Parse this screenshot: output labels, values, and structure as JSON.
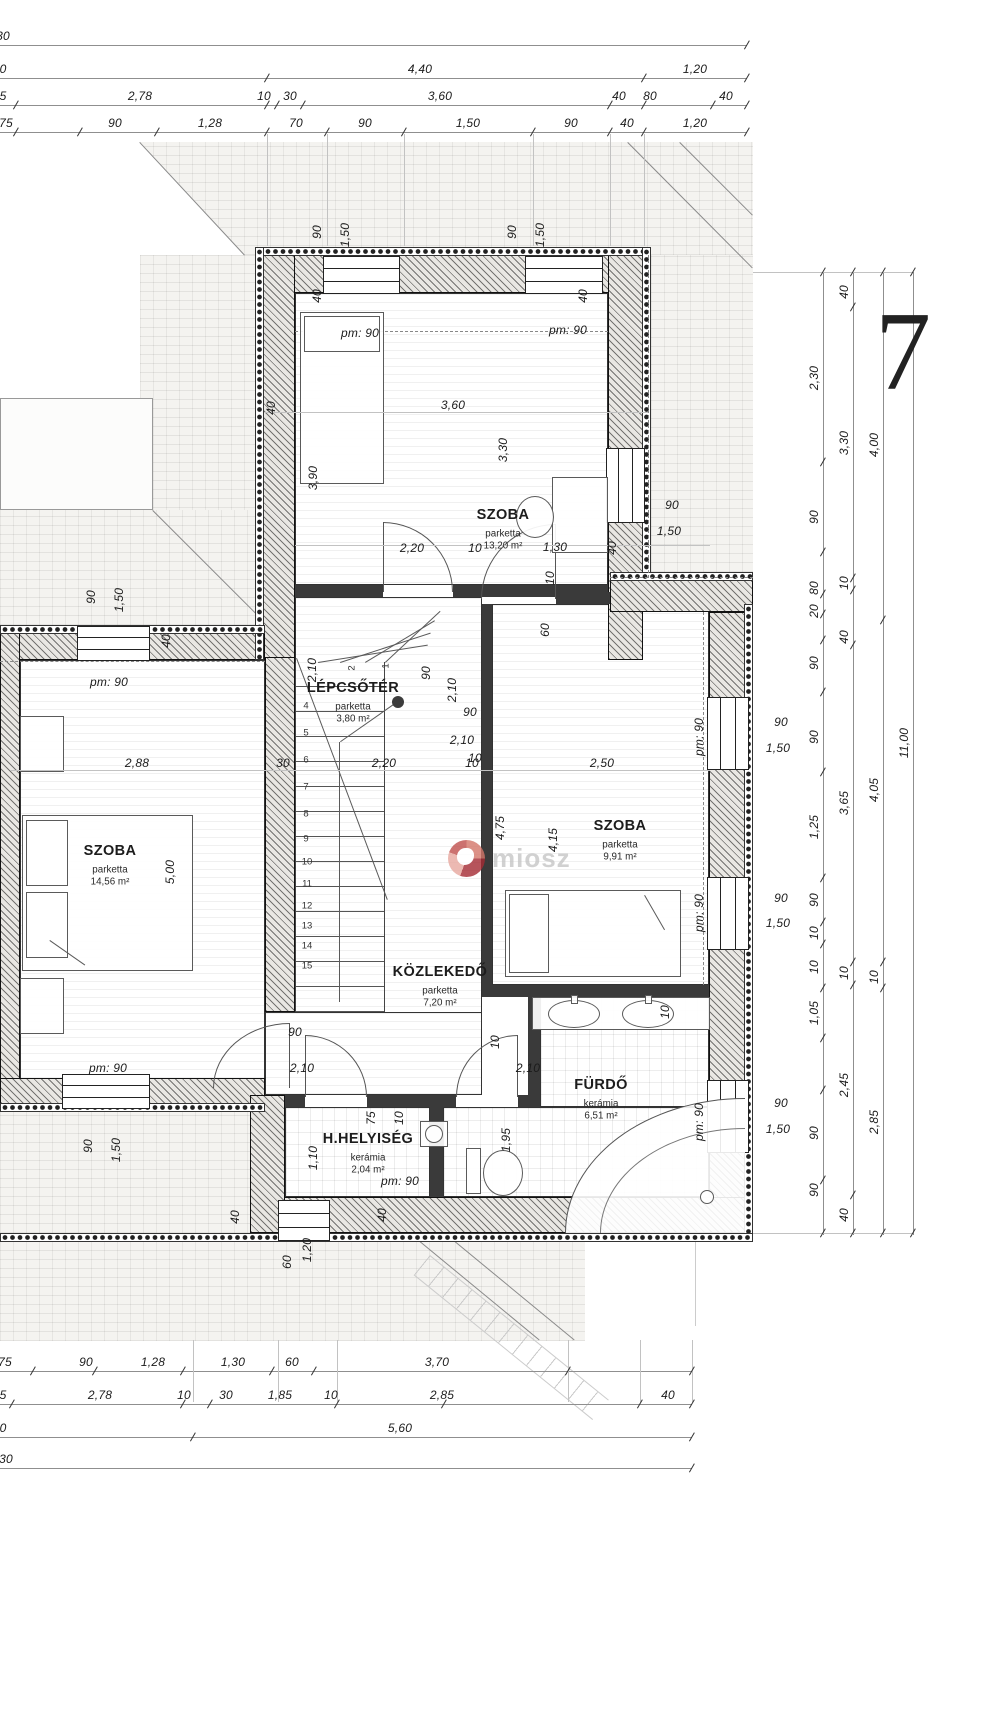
{
  "page": {
    "number": "7"
  },
  "watermark": {
    "text": "miosz"
  },
  "rooms": [
    {
      "name": "SZOBA",
      "material": "parketta",
      "area": "13,20 m²",
      "x": 503,
      "y": 515
    },
    {
      "name": "SZOBA",
      "material": "parketta",
      "area": "14,56 m²",
      "x": 110,
      "y": 851
    },
    {
      "name": "SZOBA",
      "material": "parketta",
      "area": "9,91 m²",
      "x": 620,
      "y": 826
    },
    {
      "name": "LÉPCSŐTÉR",
      "material": "parketta",
      "area": "3,80 m²",
      "x": 353,
      "y": 688
    },
    {
      "name": "KÖZLEKEDŐ",
      "material": "parketta",
      "area": "7,20 m²",
      "x": 440,
      "y": 972
    },
    {
      "name": "FÜRDŐ",
      "material": "kerámia",
      "area": "6,51 m²",
      "x": 601,
      "y": 1085
    },
    {
      "name": "H.HELYISÉG",
      "material": "kerámia",
      "area": "2,04 m²",
      "x": 368,
      "y": 1139
    }
  ],
  "dimensions": {
    "top_rows": [
      {
        "y": 45,
        "items": [
          {
            "t": "30",
            "x": 3
          }
        ]
      },
      {
        "y": 78,
        "items": [
          {
            "t": "0",
            "x": 3
          },
          {
            "t": "4,40",
            "x": 420
          },
          {
            "t": "1,20",
            "x": 695
          }
        ]
      },
      {
        "y": 105,
        "items": [
          {
            "t": "5",
            "x": 3
          },
          {
            "t": "2,78",
            "x": 140
          },
          {
            "t": "10",
            "x": 264
          },
          {
            "t": "30",
            "x": 290
          },
          {
            "t": "3,60",
            "x": 440
          },
          {
            "t": "40",
            "x": 619
          },
          {
            "t": "80",
            "x": 650
          },
          {
            "t": "40",
            "x": 726
          }
        ]
      },
      {
        "y": 132,
        "items": [
          {
            "t": "75",
            "x": 6
          },
          {
            "t": "90",
            "x": 115
          },
          {
            "t": "1,28",
            "x": 210
          },
          {
            "t": "70",
            "x": 296
          },
          {
            "t": "90",
            "x": 365
          },
          {
            "t": "1,50",
            "x": 468
          },
          {
            "t": "90",
            "x": 571
          },
          {
            "t": "40",
            "x": 627
          },
          {
            "t": "1,20",
            "x": 695
          }
        ]
      }
    ],
    "bottom_rows": [
      {
        "y": 1371,
        "items": [
          {
            "t": "75",
            "x": 5
          },
          {
            "t": "90",
            "x": 86
          },
          {
            "t": "1,28",
            "x": 153
          },
          {
            "t": "1,30",
            "x": 233
          },
          {
            "t": "60",
            "x": 292
          },
          {
            "t": "3,70",
            "x": 437
          }
        ]
      },
      {
        "y": 1404,
        "items": [
          {
            "t": "5",
            "x": 3
          },
          {
            "t": "2,78",
            "x": 100
          },
          {
            "t": "10",
            "x": 184
          },
          {
            "t": "30",
            "x": 226
          },
          {
            "t": "1,85",
            "x": 280
          },
          {
            "t": "10",
            "x": 331
          },
          {
            "t": "2,85",
            "x": 442
          },
          {
            "t": "40",
            "x": 668
          }
        ]
      },
      {
        "y": 1437,
        "items": [
          {
            "t": "0",
            "x": 3
          },
          {
            "t": "5,60",
            "x": 400
          }
        ]
      },
      {
        "y": 1468,
        "items": [
          {
            "t": "30",
            "x": 6
          }
        ]
      }
    ],
    "right_chains": [
      {
        "x": 823,
        "items": [
          {
            "t": "2,30",
            "y": 378
          },
          {
            "t": "90",
            "y": 517
          },
          {
            "t": "80",
            "y": 588
          },
          {
            "t": "20",
            "y": 611
          },
          {
            "t": "90",
            "y": 663
          },
          {
            "t": "90",
            "y": 737
          },
          {
            "t": "1,25",
            "y": 827
          },
          {
            "t": "90",
            "y": 900
          },
          {
            "t": "10",
            "y": 933
          },
          {
            "t": "10",
            "y": 967
          },
          {
            "t": "1,05",
            "y": 1013
          },
          {
            "t": "90",
            "y": 1133
          },
          {
            "t": "90",
            "y": 1190
          }
        ]
      },
      {
        "x": 853,
        "items": [
          {
            "t": "40",
            "y": 292
          },
          {
            "t": "3,30",
            "y": 443
          },
          {
            "t": "10",
            "y": 583
          },
          {
            "t": "40",
            "y": 637
          },
          {
            "t": "3,65",
            "y": 803
          },
          {
            "t": "10",
            "y": 973
          },
          {
            "t": "2,45",
            "y": 1085
          },
          {
            "t": "40",
            "y": 1215
          }
        ]
      },
      {
        "x": 883,
        "items": [
          {
            "t": "4,00",
            "y": 445
          },
          {
            "t": "4,05",
            "y": 790
          },
          {
            "t": "10",
            "y": 977
          },
          {
            "t": "2,85",
            "y": 1122
          }
        ]
      },
      {
        "x": 913,
        "items": [
          {
            "t": "11,00",
            "y": 743
          }
        ]
      }
    ],
    "plan_labels": [
      {
        "t": "90",
        "x": 317,
        "y": 232,
        "r": 1
      },
      {
        "t": "1,50",
        "x": 345,
        "y": 235,
        "r": 1
      },
      {
        "t": "90",
        "x": 512,
        "y": 232,
        "r": 1
      },
      {
        "t": "1,50",
        "x": 540,
        "y": 235,
        "r": 1
      },
      {
        "t": "90",
        "x": 91,
        "y": 597,
        "r": 1
      },
      {
        "t": "1,50",
        "x": 119,
        "y": 600,
        "r": 1
      },
      {
        "t": "90",
        "x": 88,
        "y": 1146,
        "r": 1
      },
      {
        "t": "1,50",
        "x": 116,
        "y": 1150,
        "r": 1
      },
      {
        "t": "pm: 90",
        "x": 360,
        "y": 333
      },
      {
        "t": "pm: 90",
        "x": 568,
        "y": 330
      },
      {
        "t": "pm: 90",
        "x": 109,
        "y": 682
      },
      {
        "t": "pm: 90",
        "x": 108,
        "y": 1068
      },
      {
        "t": "pm: 90",
        "x": 699,
        "y": 737,
        "r": 1
      },
      {
        "t": "pm: 90",
        "x": 699,
        "y": 913,
        "r": 1
      },
      {
        "t": "pm: 90",
        "x": 699,
        "y": 1122,
        "r": 1
      },
      {
        "t": "pm: 90",
        "x": 400,
        "y": 1181
      },
      {
        "t": "90",
        "x": 781,
        "y": 722
      },
      {
        "t": "1,50",
        "x": 778,
        "y": 748
      },
      {
        "t": "90",
        "x": 781,
        "y": 898
      },
      {
        "t": "1,50",
        "x": 778,
        "y": 923
      },
      {
        "t": "90",
        "x": 781,
        "y": 1103
      },
      {
        "t": "1,50",
        "x": 778,
        "y": 1129
      },
      {
        "t": "90",
        "x": 672,
        "y": 505
      },
      {
        "t": "1,50",
        "x": 669,
        "y": 531
      },
      {
        "t": "40",
        "x": 317,
        "y": 296,
        "r": 1
      },
      {
        "t": "40",
        "x": 583,
        "y": 296,
        "r": 1
      },
      {
        "t": "40",
        "x": 271,
        "y": 408,
        "r": 1
      },
      {
        "t": "40",
        "x": 612,
        "y": 548,
        "r": 1
      },
      {
        "t": "40",
        "x": 166,
        "y": 641,
        "r": 1
      },
      {
        "t": "40",
        "x": 235,
        "y": 1217,
        "r": 1
      },
      {
        "t": "40",
        "x": 382,
        "y": 1215,
        "r": 1
      },
      {
        "t": "3,90",
        "x": 313,
        "y": 478,
        "r": 1
      },
      {
        "t": "3,30",
        "x": 503,
        "y": 450,
        "r": 1
      },
      {
        "t": "3,60",
        "x": 453,
        "y": 405
      },
      {
        "t": "2,20",
        "x": 412,
        "y": 548
      },
      {
        "t": "10",
        "x": 475,
        "y": 548
      },
      {
        "t": "1,30",
        "x": 555,
        "y": 547
      },
      {
        "t": "2,88",
        "x": 137,
        "y": 763
      },
      {
        "t": "30",
        "x": 283,
        "y": 763
      },
      {
        "t": "2,20",
        "x": 384,
        "y": 763
      },
      {
        "t": "10",
        "x": 472,
        "y": 763
      },
      {
        "t": "2,50",
        "x": 602,
        "y": 763
      },
      {
        "t": "5,00",
        "x": 170,
        "y": 872,
        "r": 1
      },
      {
        "t": "4,75",
        "x": 500,
        "y": 828,
        "r": 1
      },
      {
        "t": "4,15",
        "x": 553,
        "y": 840,
        "r": 1
      },
      {
        "t": "2,10",
        "x": 312,
        "y": 670,
        "r": 1
      },
      {
        "t": "90",
        "x": 426,
        "y": 673,
        "r": 1
      },
      {
        "t": "2,10",
        "x": 452,
        "y": 690,
        "r": 1
      },
      {
        "t": "90",
        "x": 470,
        "y": 712
      },
      {
        "t": "2,10",
        "x": 462,
        "y": 740
      },
      {
        "t": "10",
        "x": 475,
        "y": 758
      },
      {
        "t": "10",
        "x": 550,
        "y": 578,
        "r": 1
      },
      {
        "t": "60",
        "x": 545,
        "y": 630,
        "r": 1
      },
      {
        "t": "90",
        "x": 295,
        "y": 1032
      },
      {
        "t": "2,10",
        "x": 302,
        "y": 1068
      },
      {
        "t": "2,10",
        "x": 528,
        "y": 1068
      },
      {
        "t": "10",
        "x": 495,
        "y": 1042,
        "r": 1
      },
      {
        "t": "75",
        "x": 371,
        "y": 1118,
        "r": 1
      },
      {
        "t": "10",
        "x": 399,
        "y": 1118,
        "r": 1
      },
      {
        "t": "1,10",
        "x": 313,
        "y": 1158,
        "r": 1
      },
      {
        "t": "1,95",
        "x": 506,
        "y": 1140,
        "r": 1
      },
      {
        "t": "10",
        "x": 665,
        "y": 1012,
        "r": 1
      },
      {
        "t": "60",
        "x": 287,
        "y": 1262,
        "r": 1
      },
      {
        "t": "1,20",
        "x": 307,
        "y": 1250,
        "r": 1
      }
    ]
  },
  "stairs": {
    "numbers": [
      {
        "t": "1",
        "x": 386,
        "y": 666,
        "r": 1
      },
      {
        "t": "2",
        "x": 352,
        "y": 668,
        "r": 1
      },
      {
        "t": "4",
        "x": 306,
        "y": 706
      },
      {
        "t": "5",
        "x": 306,
        "y": 733
      },
      {
        "t": "6",
        "x": 306,
        "y": 760
      },
      {
        "t": "7",
        "x": 306,
        "y": 787
      },
      {
        "t": "8",
        "x": 306,
        "y": 814
      },
      {
        "t": "9",
        "x": 306,
        "y": 839
      },
      {
        "t": "10",
        "x": 307,
        "y": 862
      },
      {
        "t": "11",
        "x": 307,
        "y": 884
      },
      {
        "t": "12",
        "x": 307,
        "y": 906
      },
      {
        "t": "13",
        "x": 307,
        "y": 926
      },
      {
        "t": "14",
        "x": 307,
        "y": 946
      },
      {
        "t": "15",
        "x": 307,
        "y": 966
      }
    ]
  },
  "decor": {
    "ticks_h": [
      [
        747,
        45
      ],
      [
        267,
        78
      ],
      [
        644,
        78
      ],
      [
        747,
        78
      ],
      [
        16,
        105
      ],
      [
        267,
        105
      ],
      [
        277,
        105
      ],
      [
        303,
        105
      ],
      [
        610,
        105
      ],
      [
        644,
        105
      ],
      [
        713,
        105
      ],
      [
        747,
        105
      ],
      [
        16,
        132
      ],
      [
        80,
        132
      ],
      [
        157,
        132
      ],
      [
        267,
        132
      ],
      [
        327,
        132
      ],
      [
        404,
        132
      ],
      [
        533,
        132
      ],
      [
        610,
        132
      ],
      [
        644,
        132
      ],
      [
        747,
        132
      ],
      [
        33,
        1371
      ],
      [
        95,
        1371
      ],
      [
        183,
        1371
      ],
      [
        272,
        1371
      ],
      [
        314,
        1371
      ],
      [
        568,
        1371
      ],
      [
        692,
        1371
      ],
      [
        12,
        1404
      ],
      [
        183,
        1404
      ],
      [
        210,
        1404
      ],
      [
        337,
        1404
      ],
      [
        444,
        1404
      ],
      [
        640,
        1404
      ],
      [
        692,
        1404
      ],
      [
        193,
        1437
      ],
      [
        692,
        1437
      ],
      [
        692,
        1468
      ]
    ],
    "ticks_v": [
      [
        823,
        272
      ],
      [
        823,
        462
      ],
      [
        823,
        552
      ],
      [
        823,
        594
      ],
      [
        823,
        614
      ],
      [
        823,
        640
      ],
      [
        823,
        692
      ],
      [
        823,
        772
      ],
      [
        823,
        878
      ],
      [
        823,
        922
      ],
      [
        823,
        944
      ],
      [
        823,
        988
      ],
      [
        823,
        1038
      ],
      [
        823,
        1090
      ],
      [
        823,
        1180
      ],
      [
        823,
        1233
      ],
      [
        853,
        272
      ],
      [
        853,
        307
      ],
      [
        853,
        578
      ],
      [
        853,
        590
      ],
      [
        853,
        645
      ],
      [
        853,
        962
      ],
      [
        853,
        985
      ],
      [
        853,
        1195
      ],
      [
        853,
        1233
      ],
      [
        883,
        272
      ],
      [
        883,
        620
      ],
      [
        883,
        962
      ],
      [
        883,
        988
      ],
      [
        883,
        1233
      ],
      [
        913,
        272
      ],
      [
        913,
        1233
      ]
    ]
  }
}
